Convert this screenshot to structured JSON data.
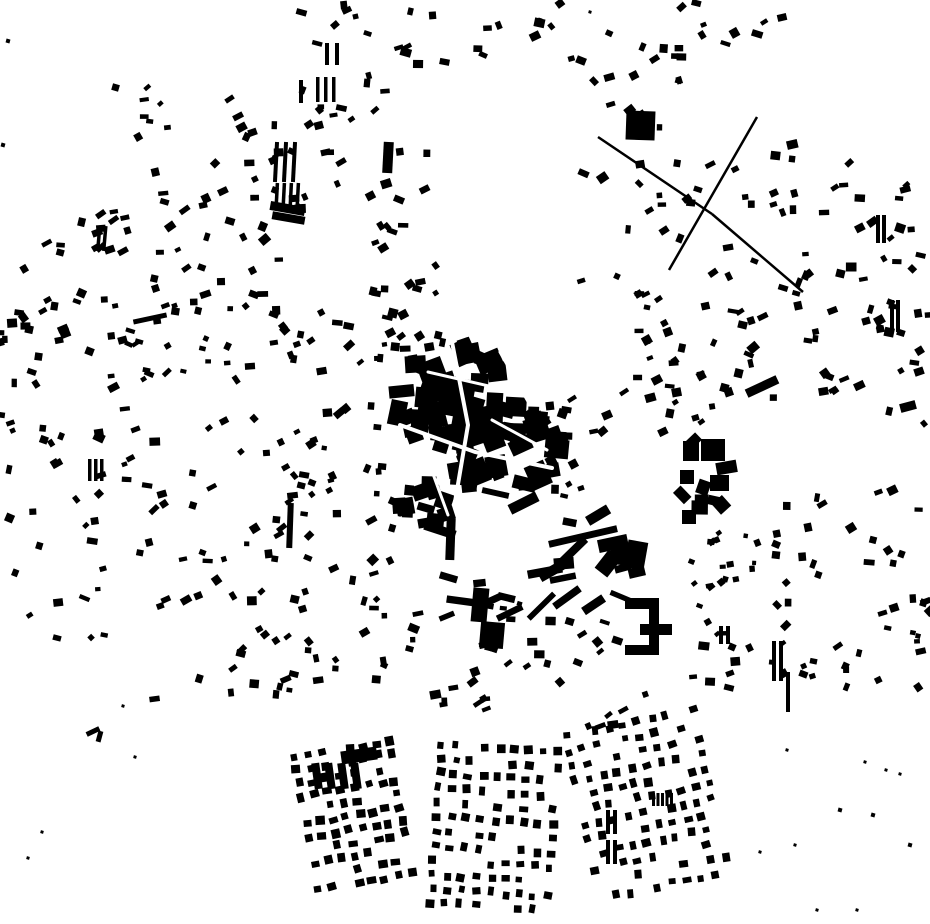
{
  "meta": {
    "kind": "figure-ground-building-footprint-map",
    "background_color": "#ffffff",
    "building_color": "#000000",
    "width": 930,
    "height": 924
  },
  "map": {
    "defaults": {
      "minW": 5,
      "maxW": 11,
      "minH": 4,
      "maxH": 9,
      "angle": -10,
      "spread": 35
    },
    "blobs": [
      [
        450,
        400,
        55,
        55,
        42,
        10,
        26
      ],
      [
        497,
        450,
        62,
        48,
        42,
        10,
        26
      ],
      [
        425,
        503,
        28,
        22,
        14,
        8,
        18
      ]
    ],
    "streets": [
      {
        "pts": [
          [
            400,
            425
          ],
          [
            475,
            452
          ],
          [
            552,
            468
          ]
        ],
        "w": 4
      },
      {
        "pts": [
          [
            452,
            342
          ],
          [
            468,
            425
          ],
          [
            455,
            502
          ]
        ],
        "w": 4
      },
      {
        "pts": [
          [
            428,
            372
          ],
          [
            515,
            392
          ]
        ],
        "w": 3
      },
      {
        "pts": [
          [
            492,
            420
          ],
          [
            547,
            450
          ]
        ],
        "w": 3
      },
      {
        "pts": [
          [
            425,
            452
          ],
          [
            448,
            515
          ]
        ],
        "w": 3
      },
      {
        "pts": [
          [
            500,
            352
          ],
          [
            530,
            405
          ]
        ],
        "w": 3
      }
    ],
    "scatters": [
      [
        115,
        82,
        80,
        60,
        8
      ],
      [
        225,
        85,
        130,
        55,
        13
      ],
      [
        155,
        150,
        130,
        85,
        18
      ],
      [
        55,
        195,
        110,
        95,
        15
      ],
      [
        0,
        238,
        68,
        105,
        11
      ],
      [
        165,
        228,
        118,
        85,
        17
      ],
      [
        288,
        148,
        62,
        85,
        9
      ],
      [
        333,
        62,
        55,
        55,
        5
      ],
      [
        398,
        8,
        105,
        58,
        11
      ],
      [
        520,
        0,
        42,
        42,
        4
      ],
      [
        300,
        2,
        75,
        42,
        7
      ],
      [
        556,
        4,
        128,
        68,
        10
      ],
      [
        690,
        2,
        108,
        66,
        8
      ],
      [
        562,
        72,
        118,
        66,
        9
      ],
      [
        580,
        140,
        180,
        150,
        24
      ],
      [
        770,
        130,
        158,
        100,
        20
      ],
      [
        762,
        232,
        165,
        115,
        24
      ],
      [
        622,
        292,
        92,
        108,
        22
      ],
      [
        556,
        398,
        160,
        40,
        11
      ],
      [
        698,
        300,
        85,
        98,
        13
      ],
      [
        876,
        300,
        54,
        128,
        13
      ],
      [
        795,
        373,
        68,
        22,
        7
      ],
      [
        0,
        292,
        118,
        128,
        20
      ],
      [
        120,
        296,
        158,
        108,
        24
      ],
      [
        282,
        302,
        118,
        78,
        16
      ],
      [
        0,
        422,
        113,
        138,
        20
      ],
      [
        115,
        408,
        168,
        148,
        27
      ],
      [
        283,
        382,
        110,
        175,
        30
      ],
      [
        0,
        562,
        105,
        80,
        9
      ],
      [
        152,
        552,
        182,
        148,
        29
      ],
      [
        332,
        556,
        92,
        142,
        18
      ],
      [
        232,
        622,
        95,
        75,
        9
      ],
      [
        368,
        150,
        62,
        98,
        12
      ],
      [
        372,
        252,
        66,
        95,
        14
      ],
      [
        390,
        330,
        60,
        55,
        9
      ],
      [
        524,
        398,
        48,
        58,
        9
      ],
      [
        545,
        452,
        42,
        50,
        7
      ],
      [
        432,
        492,
        215,
        125,
        24,
        10,
        36,
        5,
        12
      ],
      [
        470,
        590,
        100,
        78,
        14
      ],
      [
        560,
        612,
        58,
        55,
        7
      ],
      [
        676,
        436,
        52,
        84,
        9,
        10,
        22,
        8,
        16
      ],
      [
        690,
        528,
        68,
        78,
        18,
        4,
        8,
        4,
        7
      ],
      [
        772,
        480,
        158,
        135,
        24
      ],
      [
        682,
        602,
        118,
        98,
        16
      ],
      [
        802,
        602,
        128,
        88,
        18
      ],
      [
        432,
        662,
        128,
        58,
        12
      ],
      [
        560,
        682,
        88,
        55,
        6
      ]
    ],
    "grids": [
      [
        295,
        757,
        8,
        11,
        13.5,
        13.5,
        7.5,
        7.5,
        -10,
        0.22
      ],
      [
        442,
        744,
        9,
        12,
        14.5,
        14.5,
        7,
        7,
        4,
        0.2
      ],
      [
        566,
        737,
        10,
        12,
        14.5,
        15,
        7,
        7,
        -12,
        0.3
      ]
    ],
    "strips": [
      [
        274,
        142,
        3,
        4,
        40,
        9,
        3
      ],
      [
        275,
        183,
        4,
        3.5,
        25,
        7,
        3
      ],
      [
        325,
        43,
        2,
        4,
        22,
        10,
        0
      ],
      [
        316,
        77,
        3,
        3.5,
        25,
        8,
        0
      ],
      [
        299,
        80,
        1,
        4,
        23,
        0,
        0
      ],
      [
        97,
        226,
        2,
        3.5,
        25,
        6,
        5
      ],
      [
        88,
        459,
        3,
        3.5,
        22,
        6,
        0
      ],
      [
        313,
        763,
        4,
        8,
        26,
        13,
        -8
      ],
      [
        606,
        810,
        2,
        4,
        24,
        7,
        0
      ],
      [
        606,
        840,
        2,
        4,
        24,
        7,
        0
      ],
      [
        652,
        793,
        5,
        3,
        13,
        4.5,
        0
      ],
      [
        719,
        626,
        2,
        4,
        18,
        7,
        0
      ],
      [
        772,
        641,
        2,
        4,
        40,
        7,
        0
      ],
      [
        786,
        672,
        1,
        4,
        40,
        0,
        0
      ],
      [
        890,
        300,
        2,
        4,
        32,
        6,
        0
      ],
      [
        876,
        215,
        2,
        4,
        28,
        6,
        0
      ]
    ],
    "rects": [
      [
        626,
        111,
        29,
        29,
        2
      ],
      [
        383,
        142,
        10,
        31,
        3
      ],
      [
        270,
        204,
        35,
        9,
        10
      ],
      [
        272,
        214,
        33,
        8,
        10
      ],
      [
        287,
        503,
        6,
        45,
        2
      ],
      [
        446,
        518,
        9,
        42,
        2
      ],
      [
        548,
        533,
        70,
        7,
        -13
      ],
      [
        472,
        588,
        16,
        34,
        5
      ],
      [
        480,
        622,
        24,
        26,
        5
      ],
      [
        683,
        441,
        16,
        20,
        0
      ],
      [
        701,
        439,
        24,
        22,
        0
      ],
      [
        680,
        470,
        14,
        14,
        0
      ],
      [
        710,
        475,
        19,
        16,
        0
      ],
      [
        682,
        510,
        14,
        14,
        0
      ],
      [
        900,
        402,
        16,
        9,
        -15
      ],
      [
        745,
        382,
        34,
        9,
        -25
      ],
      [
        625,
        598,
        34,
        11,
        0
      ],
      [
        640,
        624,
        32,
        11,
        0
      ],
      [
        625,
        645,
        30,
        10,
        0
      ],
      [
        649,
        598,
        10,
        57,
        0
      ],
      [
        598,
        537,
        30,
        13,
        -12
      ],
      [
        610,
        545,
        27,
        18,
        15
      ],
      [
        600,
        552,
        16,
        23,
        38
      ],
      [
        626,
        541,
        20,
        28,
        10
      ],
      [
        86,
        729,
        14,
        5,
        -25
      ],
      [
        97,
        731,
        5,
        11,
        15
      ],
      [
        133,
        316,
        34,
        5,
        -12
      ],
      [
        341,
        749,
        36,
        13,
        -8
      ]
    ],
    "lines": [
      [
        598,
        137,
        712,
        214,
        2.5
      ],
      [
        757,
        117,
        669,
        270,
        2.5
      ],
      [
        712,
        214,
        803,
        292,
        2.5
      ]
    ],
    "dots": [
      [
        8,
        41,
        4
      ],
      [
        3,
        145,
        4
      ],
      [
        114,
        87,
        3
      ],
      [
        123,
        706,
        3
      ],
      [
        135,
        757,
        3
      ],
      [
        42,
        832,
        3
      ],
      [
        28,
        858,
        3
      ],
      [
        787,
        750,
        3
      ],
      [
        865,
        762,
        3
      ],
      [
        886,
        770,
        3
      ],
      [
        840,
        810,
        4
      ],
      [
        900,
        774,
        3
      ],
      [
        817,
        910,
        3
      ],
      [
        857,
        910,
        3
      ],
      [
        910,
        845,
        4
      ],
      [
        873,
        815,
        4
      ],
      [
        795,
        845,
        3
      ],
      [
        760,
        852,
        3
      ],
      [
        918,
        636,
        5
      ],
      [
        540,
        20,
        4
      ],
      [
        590,
        12,
        3
      ]
    ]
  }
}
